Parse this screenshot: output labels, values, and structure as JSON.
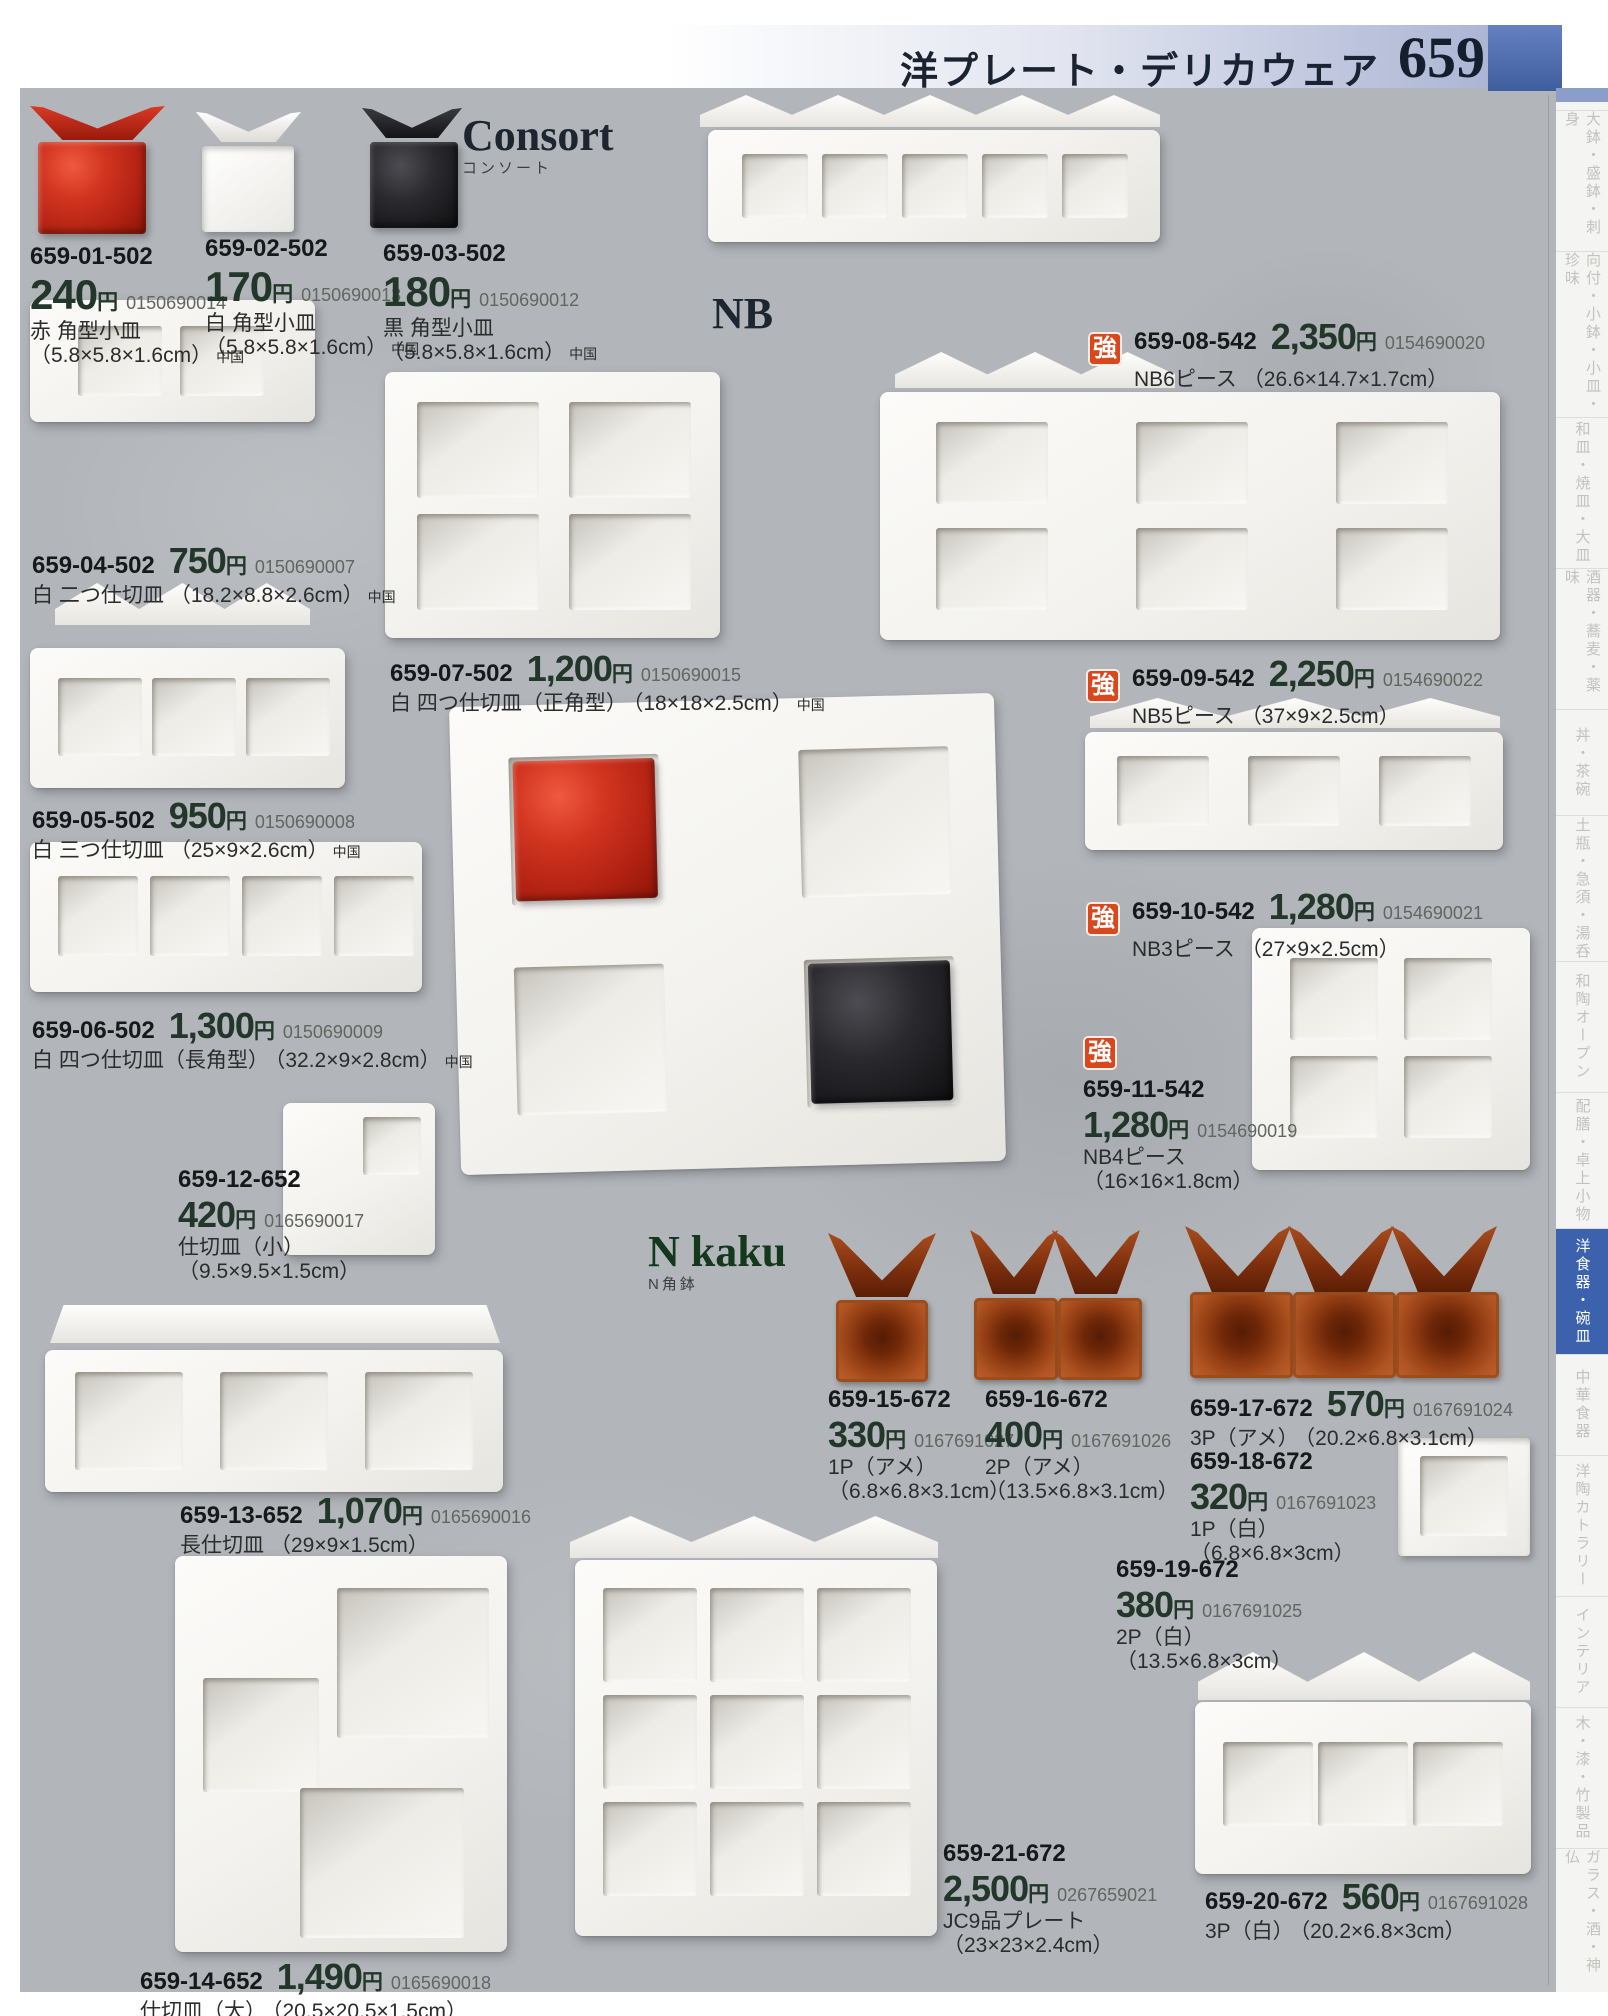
{
  "header": {
    "title": "洋プレート・デリカウェア",
    "page_number": "659"
  },
  "labels": {
    "yen": "円",
    "strong_badge": "強"
  },
  "sections": {
    "consort": {
      "title": "Consort",
      "subtitle": "コンソート"
    },
    "nb": {
      "title": "NB"
    },
    "far_east": {
      "title": "Far East",
      "subtitle": "ファーイースト"
    },
    "n_kaku": {
      "title": "N kaku",
      "subtitle": "N角鉢"
    }
  },
  "products": [
    {
      "code": "659-01-502",
      "price": "240",
      "jan": "0150690014",
      "name": "赤 角型小皿",
      "size": "（5.8×5.8×1.6cm）",
      "origin": "中国"
    },
    {
      "code": "659-02-502",
      "price": "170",
      "jan": "0150690013",
      "name": "白 角型小皿",
      "size": "（5.8×5.8×1.6cm）",
      "origin": "中国"
    },
    {
      "code": "659-03-502",
      "price": "180",
      "jan": "0150690012",
      "name": "黒 角型小皿",
      "size": "（5.8×5.8×1.6cm）",
      "origin": "中国"
    },
    {
      "code": "659-04-502",
      "price": "750",
      "jan": "0150690007",
      "name": "白 二つ仕切皿",
      "size": "（18.2×8.8×2.6cm）",
      "origin": "中国"
    },
    {
      "code": "659-05-502",
      "price": "950",
      "jan": "0150690008",
      "name": "白 三つ仕切皿",
      "size": "（25×9×2.6cm）",
      "origin": "中国"
    },
    {
      "code": "659-06-502",
      "price": "1,300",
      "jan": "0150690009",
      "name": "白 四つ仕切皿（長角型）",
      "size": "（32.2×9×2.8cm）",
      "origin": "中国"
    },
    {
      "code": "659-07-502",
      "price": "1,200",
      "jan": "0150690015",
      "name": "白 四つ仕切皿（正角型）",
      "size": "（18×18×2.5cm）",
      "origin": "中国"
    },
    {
      "code": "659-08-542",
      "price": "2,350",
      "jan": "0154690020",
      "name": "NB6ピース",
      "size": "（26.6×14.7×1.7cm）",
      "badge": "強"
    },
    {
      "code": "659-09-542",
      "price": "2,250",
      "jan": "0154690022",
      "name": "NB5ピース",
      "size": "（37×9×2.5cm）",
      "badge": "強"
    },
    {
      "code": "659-10-542",
      "price": "1,280",
      "jan": "0154690021",
      "name": "NB3ピース",
      "size": "（27×9×2.5cm）",
      "badge": "強"
    },
    {
      "code": "659-11-542",
      "price": "1,280",
      "jan": "0154690019",
      "name": "NB4ピース",
      "size": "（16×16×1.8cm）",
      "badge": "強"
    },
    {
      "code": "659-12-652",
      "price": "420",
      "jan": "0165690017",
      "name": "仕切皿（小）",
      "size": "（9.5×9.5×1.5cm）"
    },
    {
      "code": "659-13-652",
      "price": "1,070",
      "jan": "0165690016",
      "name": "長仕切皿",
      "size": "（29×9×1.5cm）"
    },
    {
      "code": "659-14-652",
      "price": "1,490",
      "jan": "0165690018",
      "name": "仕切皿（大）",
      "size": "（20.5×20.5×1.5cm）"
    },
    {
      "code": "659-15-672",
      "price": "330",
      "jan": "0167691027",
      "name": "1P（アメ）",
      "size": "（6.8×6.8×3.1cm）"
    },
    {
      "code": "659-16-672",
      "price": "400",
      "jan": "0167691026",
      "name": "2P（アメ）",
      "size": "（13.5×6.8×3.1cm）"
    },
    {
      "code": "659-17-672",
      "price": "570",
      "jan": "0167691024",
      "name": "3P（アメ）",
      "size": "（20.2×6.8×3.1cm）"
    },
    {
      "code": "659-18-672",
      "price": "320",
      "jan": "0167691023",
      "name": "1P（白）",
      "size": "（6.8×6.8×3cm）"
    },
    {
      "code": "659-19-672",
      "price": "380",
      "jan": "0167691025",
      "name": "2P（白）",
      "size": "（13.5×6.8×3cm）"
    },
    {
      "code": "659-20-672",
      "price": "560",
      "jan": "0167691028",
      "name": "3P（白）",
      "size": "（20.2×6.8×3cm）"
    },
    {
      "code": "659-21-672",
      "price": "2,500",
      "jan": "0267659021",
      "name": "JC9品プレート",
      "size": "（23×23×2.4cm）"
    }
  ],
  "sidebar": {
    "tabs": [
      {
        "label": "大鉢・盛鉢・刺身",
        "active": false
      },
      {
        "label": "向付・小鉢・小皿・珍味",
        "active": false
      },
      {
        "label": "和皿・焼皿・大皿",
        "active": false
      },
      {
        "label": "酒器・蕎麦・薬味",
        "active": false
      },
      {
        "label": "丼・茶碗",
        "active": false
      },
      {
        "label": "土瓶・急須・湯呑",
        "active": false
      },
      {
        "label": "和陶オープン",
        "active": false
      },
      {
        "label": "配膳・卓上小物",
        "active": false
      },
      {
        "label": "洋食器・碗皿",
        "active": true
      },
      {
        "label": "中華食器",
        "active": false
      },
      {
        "label": "洋陶カトラリー",
        "active": false
      },
      {
        "label": "インテリア",
        "active": false
      },
      {
        "label": "木・漆・竹製品",
        "active": false
      },
      {
        "label": "ガラス・酒・神仏",
        "active": false
      }
    ]
  },
  "colors": {
    "accent_blue": "#3d62ad",
    "badge_orange": "#d9481c",
    "price_dark": "#223629",
    "red_dish": "#c52815",
    "black_dish": "#1d1d20",
    "amber_dish": "#a04a1c",
    "background": "#b2b6ba"
  }
}
